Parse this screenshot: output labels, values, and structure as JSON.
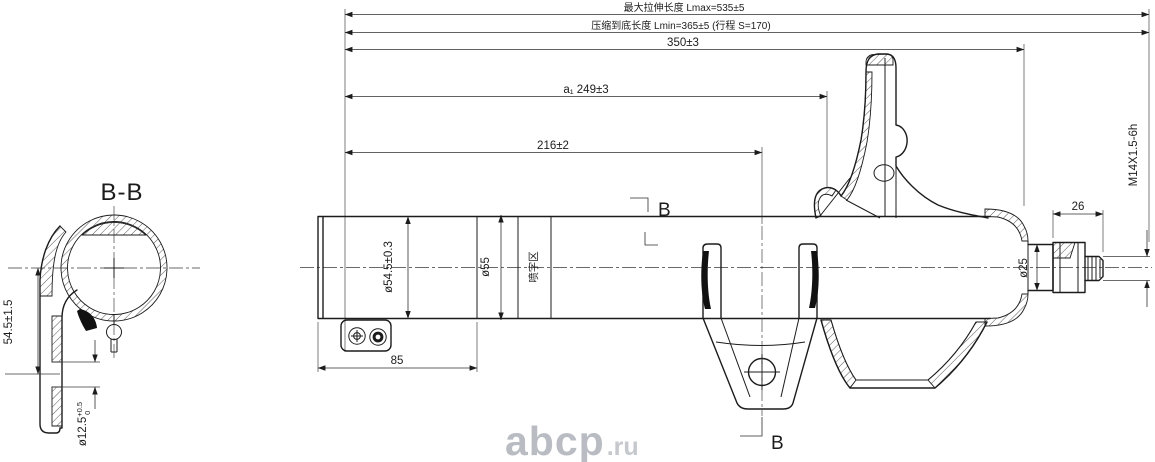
{
  "section_view": {
    "title": "B-B",
    "dim_height": "54.5±1.5",
    "dim_hole": {
      "value": "ø12.5",
      "sup": "+0.5",
      "sub": "0"
    }
  },
  "top_dims": {
    "lmax": "最大拉伸长度 Lmax=535±5",
    "lmin": "压缩到底长度 Lmin=365±5 (行程 S=170)",
    "d350": "350±3",
    "d249": "a₁ 249±3",
    "d216": "216±2"
  },
  "body_dims": {
    "d85": "85",
    "dia_54_5": "ø54.5±0.3",
    "dia_55": "ø55",
    "band_label": "喷字区",
    "dia_25": "ø25",
    "d26": "26",
    "thread": "M14X1.5-6h",
    "section_marker": "B"
  },
  "watermark": {
    "name": "abcp",
    "tld": ".ru"
  },
  "colors": {
    "line": "#1c1c1c",
    "watermark": "#b9bcc2",
    "background": "#ffffff"
  }
}
